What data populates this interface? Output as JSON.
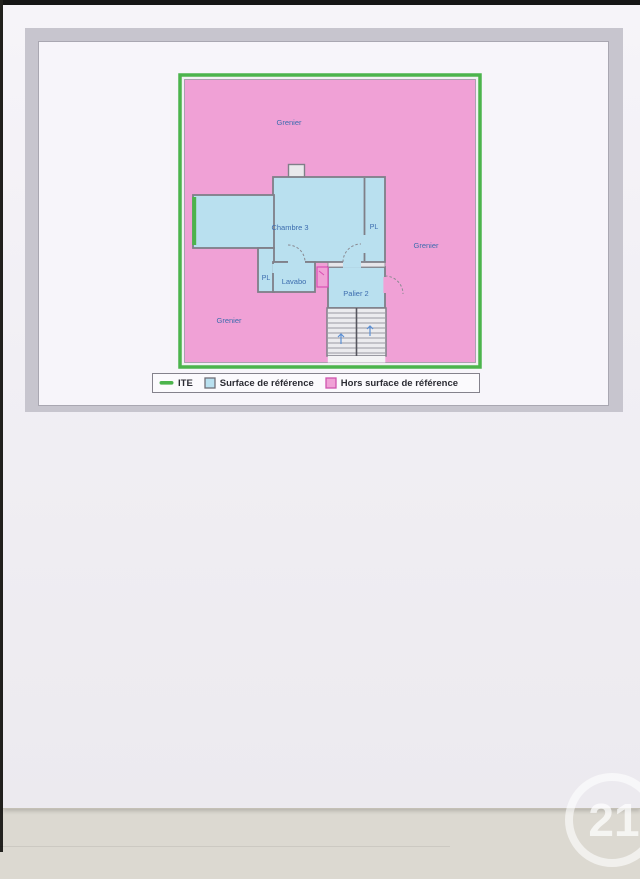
{
  "page": {
    "title": "2ème Etage"
  },
  "plan": {
    "labels": [
      {
        "text": "Grenier",
        "area": "grenier-top"
      },
      {
        "text": "Grenier",
        "area": "grenier-right"
      },
      {
        "text": "Grenier",
        "area": "grenier-bottom-left"
      },
      {
        "text": "Chambre 3",
        "area": "chambre-3"
      },
      {
        "text": "PL",
        "area": "placard-right"
      },
      {
        "text": "PL",
        "area": "placard-lower"
      },
      {
        "text": "Lavabo",
        "area": "lavabo"
      },
      {
        "text": "Palier 2",
        "area": "palier-2"
      }
    ]
  },
  "legend": {
    "items": [
      {
        "label": "ITE",
        "swatch": "line",
        "color": "#4cb44c"
      },
      {
        "label": "Surface de référence",
        "swatch": "square",
        "fill": "#b9e0ef",
        "border": "#6f6f78"
      },
      {
        "label": "Hors surface de référence",
        "swatch": "square",
        "fill": "#f0a1d6",
        "border": "#cf54ae"
      }
    ]
  },
  "colors": {
    "ite_green": "#4cb44c",
    "surface_blue": "#b9e0ef",
    "hors_surface_pink": "#f0a1d6",
    "wall_gray": "#7f7f88",
    "label_blue": "#3c6cae"
  },
  "watermark": {
    "text": "21"
  }
}
